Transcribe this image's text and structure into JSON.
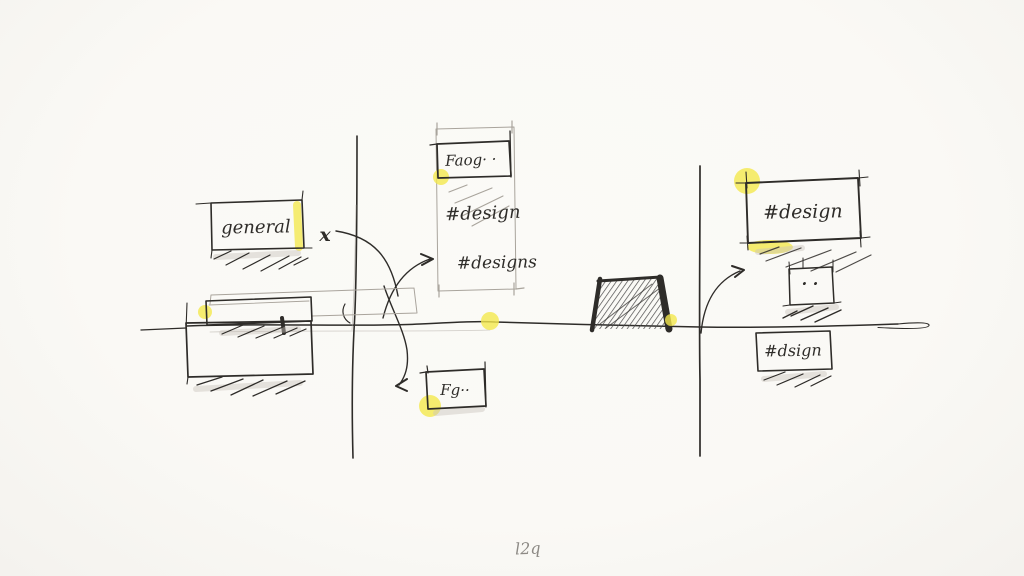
{
  "canvas": {
    "bg": "#faf9f5",
    "ink": "#2e2c29",
    "faint": "#a9a49c",
    "shadow": "#c9c4bc",
    "highlight": "#f4e84d",
    "caption": "#8d8a85"
  },
  "labels": {
    "general_box": "general",
    "x_mark": "x",
    "feed_box": "Faog· ·",
    "channel_design": "#design",
    "channel_designs": "#designs",
    "fg_box": "Fg··",
    "design_box": "#design",
    "dots_box": "· ·",
    "dsign_box": "#dsign",
    "caption": "l2q"
  }
}
